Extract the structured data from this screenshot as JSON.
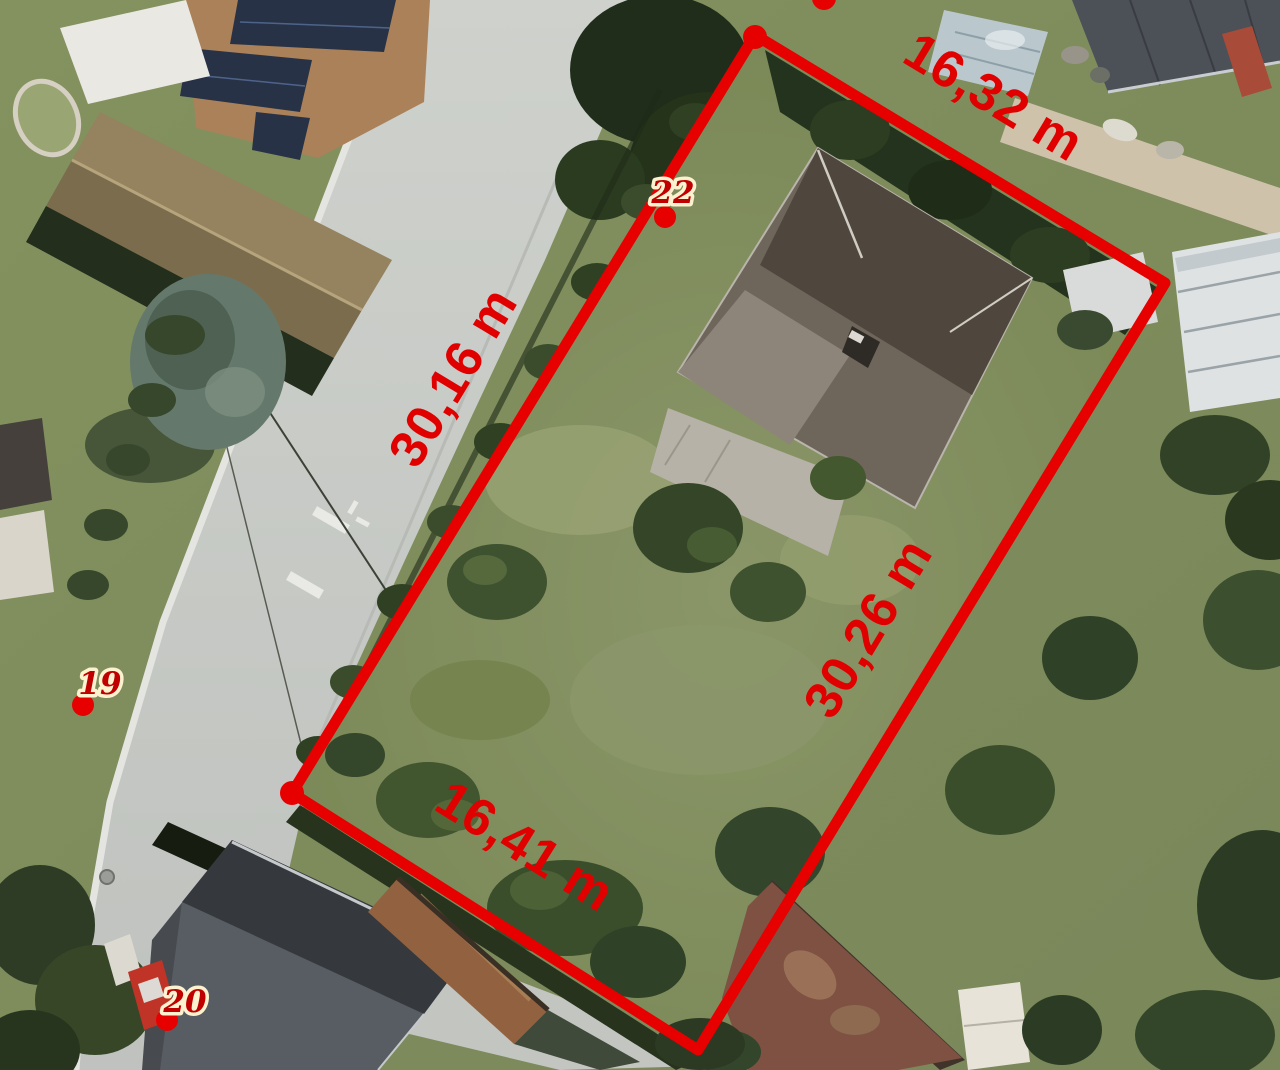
{
  "image": {
    "description": "Aerial orthophoto of a residential parcel with red survey measurement overlay"
  },
  "overlay": {
    "line_color": "#e60000",
    "dimension_color": "#e10000",
    "point_text_color": "#c00000",
    "point_halo_color": "#fcf2cf",
    "dimensions": {
      "top": "16,32 m",
      "left": "30,16 m",
      "right": "30,26 m",
      "bottom": "16,41 m"
    },
    "measurements_m": {
      "top": 16.32,
      "left": 30.16,
      "right": 30.26,
      "bottom": 16.41
    },
    "points": [
      {
        "id": "22"
      },
      {
        "id": "19"
      },
      {
        "id": "20"
      }
    ]
  }
}
